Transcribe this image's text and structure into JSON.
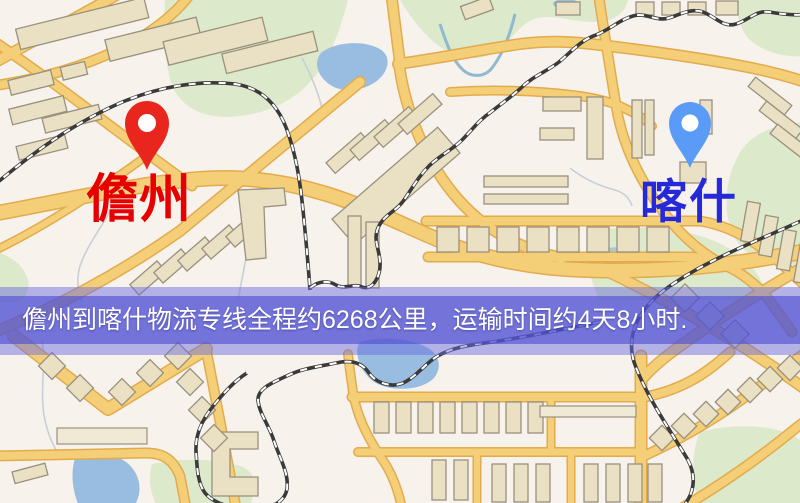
{
  "map_overlay": {
    "banner_text": "儋州到喀什物流专线全程约6268公里，运输时间约4天8小时.",
    "origin": {
      "name": "儋州",
      "pin_color": "#e8261d",
      "label_color": "#e60000"
    },
    "destination": {
      "name": "喀什",
      "pin_color": "#5b9bf8",
      "label_color": "#2629d8"
    },
    "route": {
      "distance_text": "约6268公里",
      "duration_text": "约4天8小时"
    }
  },
  "map_colors": {
    "background": "#f7f2ec",
    "road_fill": "#f4cf78",
    "road_casing": "#e2ab4e",
    "park": "#dce9ca",
    "water": "#98bde0",
    "building": "#eae0c3",
    "railway": "#3a3a3a",
    "banner": "#5a5cd6"
  }
}
